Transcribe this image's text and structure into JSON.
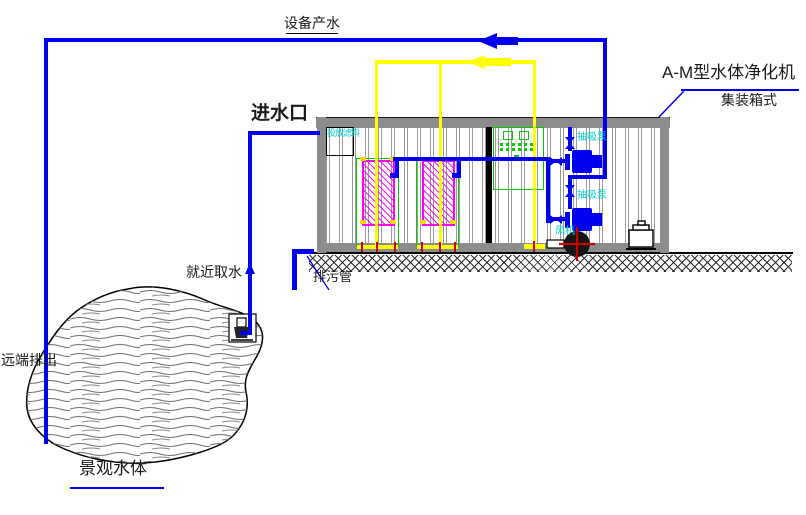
{
  "diagram": {
    "flow_labels": {
      "product_water": "设备产水",
      "inlet": "进水口",
      "nearby_intake": "就近取水",
      "remote_discharge": "远端排出",
      "drain_pipe": "排污管"
    },
    "machine": {
      "name": "A-M型水体净化机",
      "type": "集装箱式",
      "filter_media_port": "投放滤料",
      "pump_1": "抽吸泵",
      "pump_2": "抽吸泵",
      "fan": "风机"
    },
    "water_body": {
      "label": "景观水体"
    },
    "colors": {
      "water_pipe": "#0000EE",
      "aeration_pipe": "#FFFF00",
      "filter_unit": "#FF00FF",
      "equipment_frame": "#00CC00",
      "equipment_text": "#00CFCF",
      "container_wall": "#8C8C8C",
      "centerline_red": "#CC0000"
    }
  }
}
